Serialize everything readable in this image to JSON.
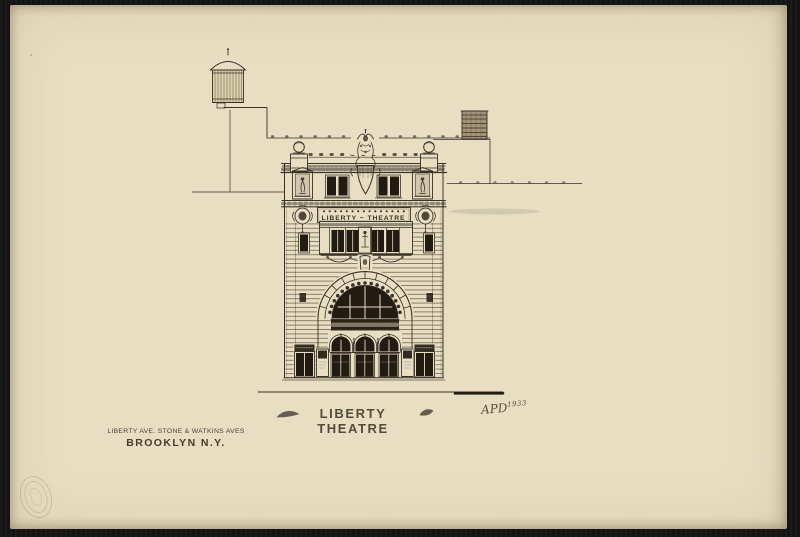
{
  "artwork": {
    "title": "LIBERTY THEATRE",
    "marquee_text": "LIBERTY ~ THEATRE",
    "signature_initials": "APD",
    "signature_year": "1933",
    "address_line1": "LIBERTY AVE. STONE & WATKINS AVES",
    "address_line2": "BROOKLYN N.Y."
  },
  "colors": {
    "paper": "#e8dfc3",
    "mat_border": "#141414",
    "ink": "#3a3128",
    "window_dark": "#221b12"
  }
}
